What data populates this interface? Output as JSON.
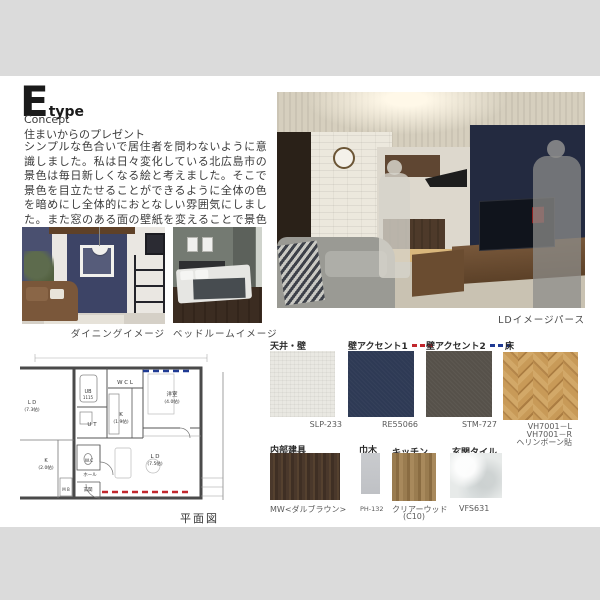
{
  "header": {
    "letter": "E",
    "sub": "type"
  },
  "concept": {
    "heading": "Concept",
    "subtitle": "住まいからのプレゼント",
    "body": "シンプルな色合いで居住者を問わないように意識しました。私は日々変化している北広島市の景色は毎日新しくなる絵と考えました。そこで景色を目立たせることができるように全体の色を暗めにし全体的におとなしい雰囲気にしました。また窓のある面の壁紙を変えることで景色の見え方も意識しました。"
  },
  "captions": {
    "dining": "ダイニングイメージ",
    "bedroom": "ベッドルームイメージ",
    "ld": "LDイメージパース",
    "plan": "平面図"
  },
  "plan": {
    "wcl": "W C L",
    "bedroom": "洋室",
    "bedroom_size": "(4.0帖)",
    "ub": "UB",
    "ub_size": "1115",
    "ut": "U T",
    "k": "K",
    "k_size": "(1.9帖)",
    "ld": "L D",
    "ld_size": "(7.5帖)",
    "wc": "W.C",
    "hall": "ホール",
    "entrance": "玄関",
    "mb": "M B",
    "neighbor_ld": "L D",
    "neighbor_ld_size": "(7.3帖)",
    "neighbor_k": "K",
    "neighbor_k_size": "(2.0帖)"
  },
  "materials": {
    "ceiling_wall": {
      "label": "天井・壁",
      "code": "SLP-233"
    },
    "wall_accent1": {
      "label": "壁アクセント1",
      "code": "RE55066"
    },
    "wall_accent2": {
      "label": "壁アクセント2",
      "code": "STM-727"
    },
    "floor": {
      "label": "床",
      "code1": "VH7001－L",
      "code2": "VH7001－R",
      "code3": "ヘリンボーン貼"
    },
    "interior_door": {
      "label": "内部建具",
      "code": "MW<ダルブラウン>"
    },
    "baseboard": {
      "label": "巾木",
      "code": "PH-132"
    },
    "kitchen": {
      "label": "キッチン",
      "code": "クリアーウッド",
      "code_sub": "(C10)"
    },
    "entrance_tile": {
      "label": "玄関タイル",
      "code": "VFS631"
    }
  },
  "colors": {
    "accent1_dash": "#c1272d",
    "accent2_dash": "#1f3a93",
    "accent_navy": "#2e3a55",
    "accent_taupe": "#56514a",
    "wallpaper_white": "#e9e8e2",
    "floor_oak": "#c89a58",
    "paper": "#ffffff",
    "canvas": "#dbdbdb"
  }
}
